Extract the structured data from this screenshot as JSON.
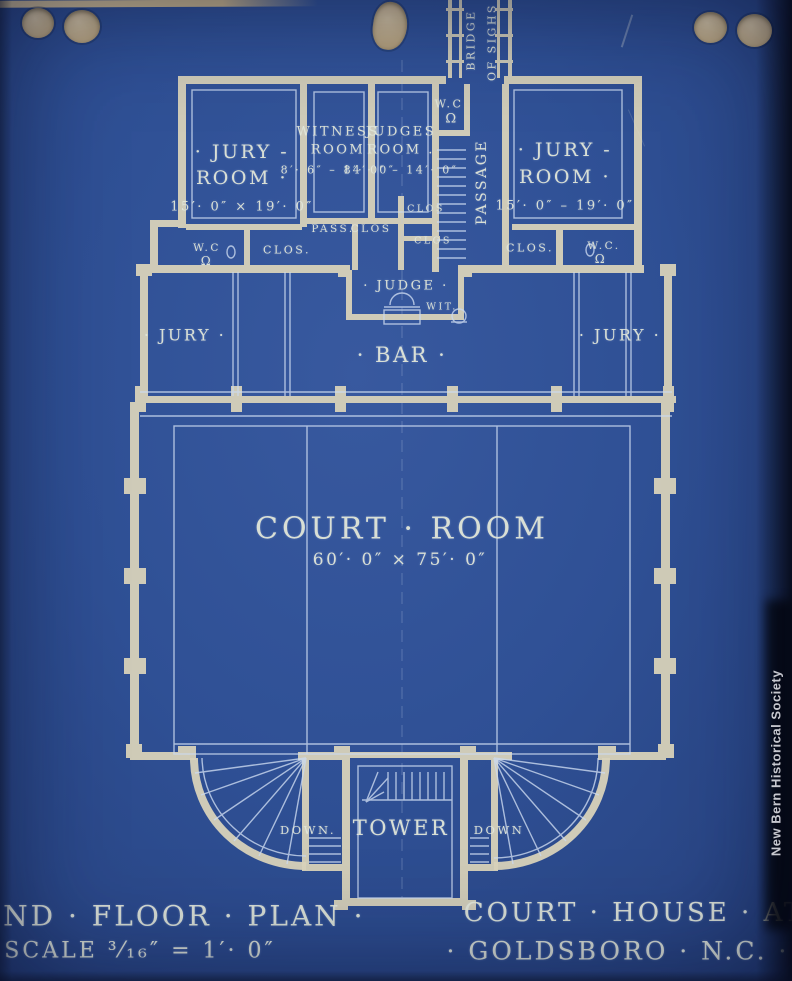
{
  "colors": {
    "blueprint_blue": "#2f5095",
    "line_cream": "#d8d2ba",
    "label_white": "#e2e7d9",
    "hole_tan": "#c6b291",
    "watermark_bg": "#000000",
    "watermark_text": "#ffffff"
  },
  "watermark": {
    "text": "New Bern Historical Society"
  },
  "titles": {
    "plan_line1": "· 2ND · FLOOR · PLAN ·",
    "plan_line2": "SCALE ³⁄₁₆″ = 1′· 0″",
    "project_line1": "COURT · HOUSE · AT",
    "project_line2": "· GOLDSBORO · N.C. ·"
  },
  "rooms": {
    "bridge": {
      "line1": "BRIDGE",
      "line2": "OF SIGHS"
    },
    "jury_room_left": {
      "line1": "· JURY -",
      "line2": "ROOM ·",
      "dims": "15′· 0″ × 19′· 0″"
    },
    "witness_room": {
      "line1": "WITNESS",
      "line2": "ROOM",
      "dims": "8′· 6″ – 14′· 0″"
    },
    "judges_room": {
      "line1": "JUDGES",
      "line2": "ROOM .",
      "dims": "8′· 0″ – 14′· 0″"
    },
    "passage": {
      "label": "PASSAGE"
    },
    "jury_room_right": {
      "line1": "· JURY -",
      "line2": "ROOM ·",
      "dims": "15′· 0″ – 19′· 0″"
    },
    "wc_top": {
      "label": "W.C"
    },
    "wc_left": {
      "label": "W.C"
    },
    "wc_right": {
      "label": "W.C."
    },
    "clos_left": {
      "label": "CLOS."
    },
    "pass_small": {
      "label": "PASS."
    },
    "clos_center_1": {
      "label": "CLOS"
    },
    "clos_center_2": {
      "label": "CLOS"
    },
    "clos_center_3": {
      "label": "CLOS"
    },
    "clos_right": {
      "label": "CLOS."
    },
    "judge": {
      "label": "· JUDGE ·"
    },
    "witness_stand": {
      "label": "WIT."
    },
    "jury_left": {
      "label": "· JURY ·"
    },
    "jury_right": {
      "label": "· JURY ·"
    },
    "bar": {
      "label": "· BAR ·"
    },
    "court_room": {
      "label": "COURT · ROOM",
      "dims": "60′· 0″ × 75′· 0″"
    },
    "tower": {
      "label": "TOWER"
    },
    "down_left": {
      "label": "DOWN."
    },
    "down_right": {
      "label": "DOWN"
    }
  },
  "icons": {
    "toilet": "Ω"
  }
}
